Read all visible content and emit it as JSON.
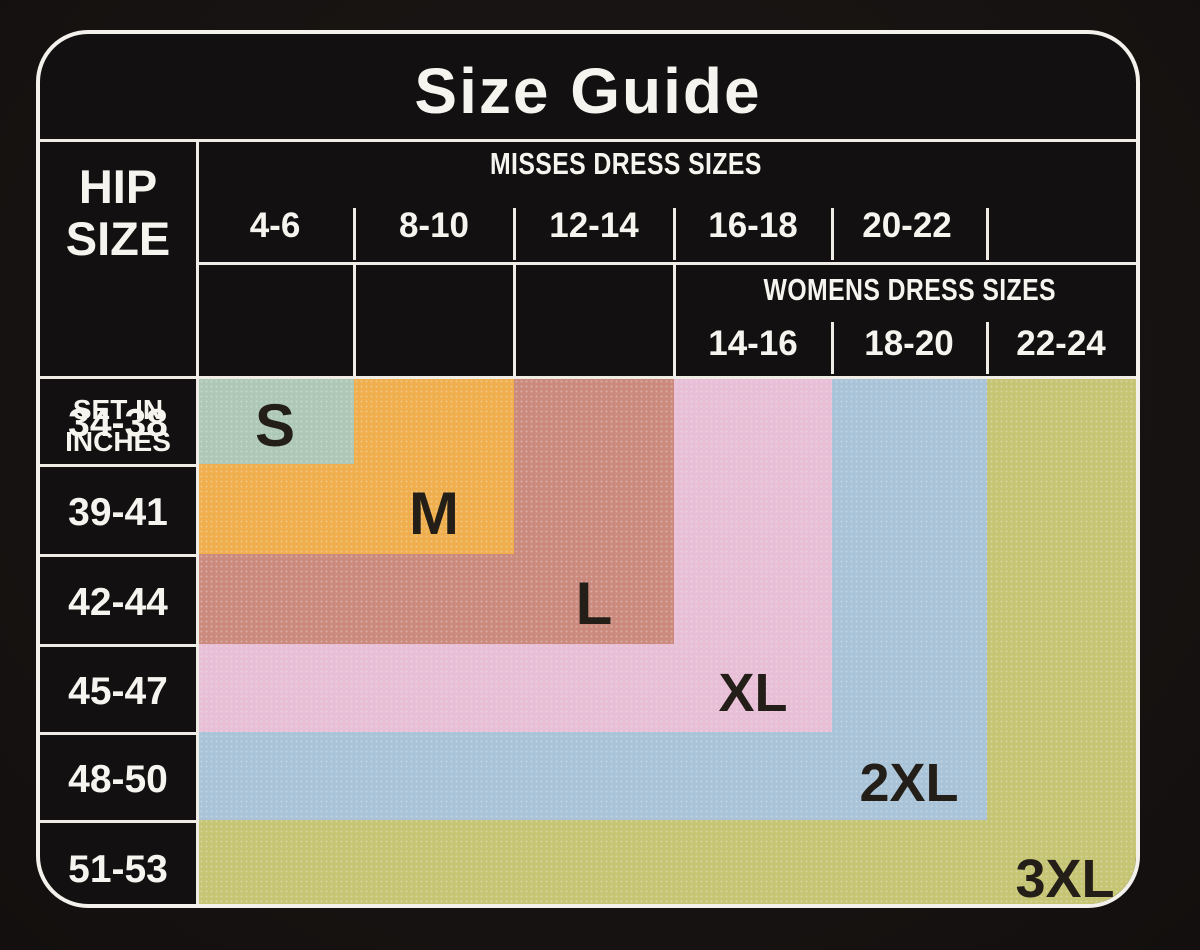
{
  "title": "Size Guide",
  "hip_column": {
    "title_top": "HIP",
    "title_bottom": "SIZE",
    "subtitle_top": "SET IN",
    "subtitle_bottom": "INCHES",
    "rows": [
      "34-38",
      "39-41",
      "42-44",
      "45-47",
      "48-50",
      "51-53"
    ]
  },
  "misses": {
    "header": "MISSES DRESS SIZES",
    "sizes": [
      "4-6",
      "8-10",
      "12-14",
      "16-18",
      "20-22"
    ]
  },
  "womens": {
    "header": "WOMENS DRESS SIZES",
    "sizes": [
      "14-16",
      "18-20",
      "22-24"
    ]
  },
  "regions": [
    {
      "label": "S",
      "color": "#aec8b6"
    },
    {
      "label": "M",
      "color": "#f0af4c"
    },
    {
      "label": "L",
      "color": "#cc8a7d"
    },
    {
      "label": "XL",
      "color": "#e8bfd7"
    },
    {
      "label": "2XL",
      "color": "#a9c4d8"
    },
    {
      "label": "3XL",
      "color": "#c6c573"
    }
  ],
  "colors": {
    "card_background": "#121010",
    "grid_line": "#efece6",
    "header_text": "#f6f4ef",
    "region_label_text": "#241e18"
  },
  "chart_data": {
    "type": "table",
    "title": "Size Guide",
    "row_axis_label": "HIP SIZE SET IN INCHES",
    "rows": [
      "34-38",
      "39-41",
      "42-44",
      "45-47",
      "48-50",
      "51-53"
    ],
    "column_groups": [
      {
        "label": "MISSES DRESS SIZES",
        "columns": [
          "4-6",
          "8-10",
          "12-14",
          "16-18",
          "20-22"
        ]
      },
      {
        "label": "WOMENS DRESS SIZES",
        "columns": [
          "14-16",
          "18-20",
          "22-24"
        ]
      }
    ],
    "cells": [
      [
        "S",
        "M",
        "L",
        "XL",
        "2XL",
        "3XL"
      ],
      [
        "M",
        "M",
        "L",
        "XL",
        "2XL",
        "3XL"
      ],
      [
        "L",
        "L",
        "L",
        "XL",
        "2XL",
        "3XL"
      ],
      [
        "XL",
        "XL",
        "XL",
        "XL",
        "2XL",
        "3XL"
      ],
      [
        "2XL",
        "2XL",
        "2XL",
        "2XL",
        "2XL",
        "3XL"
      ],
      [
        "3XL",
        "3XL",
        "3XL",
        "3XL",
        "3XL",
        "3XL"
      ]
    ],
    "series": [
      {
        "name": "S",
        "color": "#aec8b6",
        "hip_rows_covered": 1,
        "dress_columns_covered": 1
      },
      {
        "name": "M",
        "color": "#f0af4c",
        "hip_rows_covered": 2,
        "dress_columns_covered": 2
      },
      {
        "name": "L",
        "color": "#cc8a7d",
        "hip_rows_covered": 3,
        "dress_columns_covered": 3
      },
      {
        "name": "XL",
        "color": "#e8bfd7",
        "hip_rows_covered": 4,
        "dress_columns_covered": 4
      },
      {
        "name": "2XL",
        "color": "#a9c4d8",
        "hip_rows_covered": 5,
        "dress_columns_covered": 5
      },
      {
        "name": "3XL",
        "color": "#c6c573",
        "hip_rows_covered": 6,
        "dress_columns_covered": 6
      }
    ],
    "legend_position": "in-cell labels",
    "grid": true
  }
}
